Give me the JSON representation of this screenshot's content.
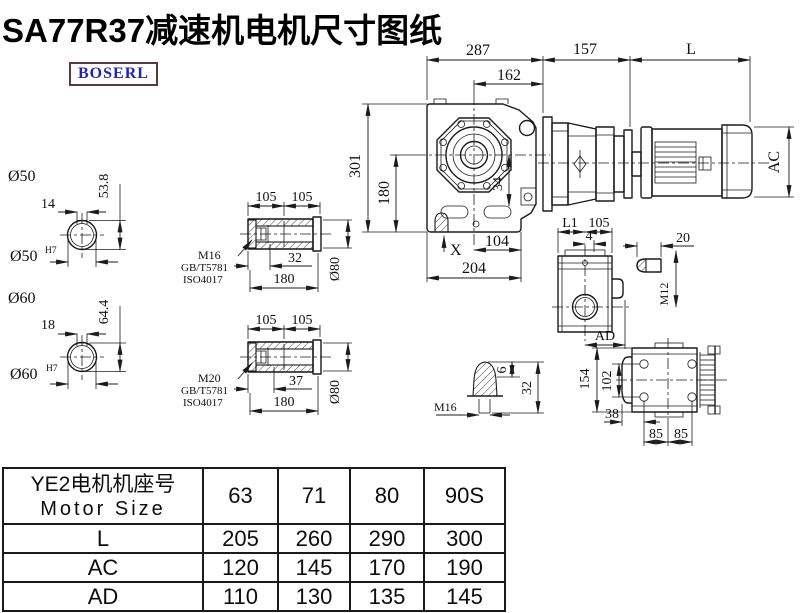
{
  "page": {
    "title": "SA77R37减速机电机尺寸图纸",
    "brand": "BOSERL"
  },
  "labels": {
    "front": {
      "d287": "287",
      "d162": "162",
      "d301": "301",
      "d180": "180",
      "d34": "34",
      "x": "X",
      "d104": "104",
      "d204": "204"
    },
    "side": {
      "d157": "157",
      "L": "L",
      "AC": "AC"
    },
    "sec50": {
      "dia": "Ø50",
      "dia_fit": "Ø50",
      "fit": "H7",
      "w": "14",
      "h": "53.8"
    },
    "sec60": {
      "dia": "Ø60",
      "dia_fit": "Ø60",
      "fit": "H7",
      "w": "18",
      "h": "64.4"
    },
    "hollow1": {
      "p1": "105",
      "p2": "105",
      "bolt": "M16",
      "std1": "GB/T5781",
      "std2": "ISO4017",
      "depth": "32",
      "len": "180",
      "dia": "Ø80"
    },
    "hollow2": {
      "p1": "105",
      "p2": "105",
      "bolt": "M20",
      "std1": "GB/T5781",
      "std2": "ISO4017",
      "depth": "37",
      "len": "180",
      "dia": "Ø80"
    },
    "top": {
      "L1": "L1",
      "d105": "105",
      "d4": "4",
      "AD": "AD"
    },
    "key": {
      "d20": "20",
      "thread": "M12"
    },
    "plug": {
      "d6": "6",
      "d32": "32",
      "thread": "M16"
    },
    "back": {
      "d154": "154",
      "d102": "102",
      "d38": "38",
      "d85a": "85",
      "d85b": "85"
    }
  },
  "table": {
    "header_line1": "YE2电机机座号",
    "header_line2": "Motor Size",
    "columns": [
      "63",
      "71",
      "80",
      "90S"
    ],
    "rows": [
      {
        "label": "L",
        "values": [
          "205",
          "260",
          "290",
          "300"
        ]
      },
      {
        "label": "AC",
        "values": [
          "120",
          "145",
          "170",
          "190"
        ]
      },
      {
        "label": "AD",
        "values": [
          "110",
          "130",
          "135",
          "145"
        ]
      }
    ]
  }
}
